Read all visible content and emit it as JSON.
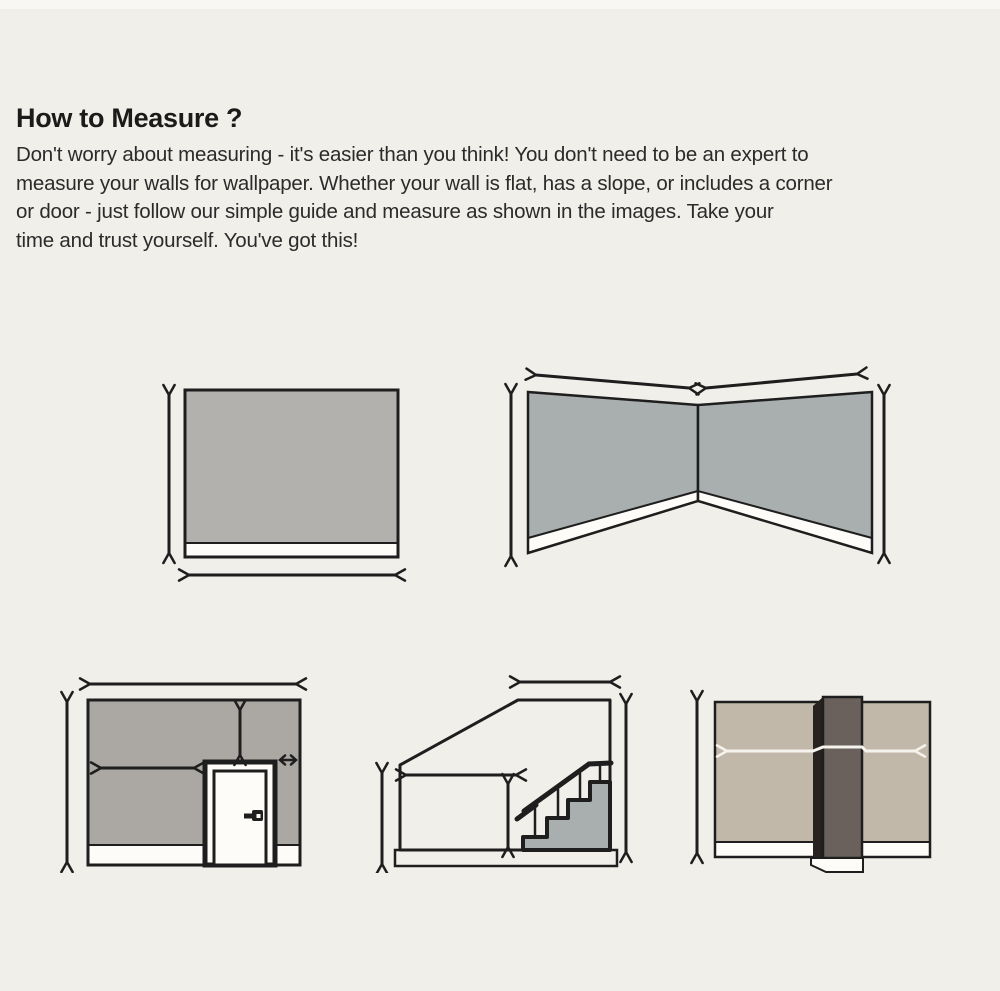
{
  "header": {
    "title": "How to Measure ?",
    "paragraph_lines": [
      "Don't worry about measuring - it's easier than you think! You don't need to be an expert to",
      "measure your walls for wallpaper. Whether your wall is flat, has a slope, or includes a corner",
      "or door - just follow our simple guide and measure as shown in the images. Take your",
      "time and trust yourself. You've got this!"
    ]
  },
  "colors": {
    "background": "#f1efe9",
    "top_strip": "#f9f7f3",
    "ink": "#1e1e1e",
    "wall_flat": "#b3b1ae",
    "wall_cool": "#a9aeae",
    "wall_door": "#aba8a3",
    "wall_taupe": "#c1b8aa",
    "column_front": "#6a605c",
    "column_side": "#27211f",
    "baseboard": "#fdfcf8",
    "arrow_white": "#f6f3ed"
  },
  "diagrams": [
    {
      "name": "flat-wall-diagram"
    },
    {
      "name": "corner-wall-diagram"
    },
    {
      "name": "door-wall-diagram"
    },
    {
      "name": "sloped-wall-stairs-diagram"
    },
    {
      "name": "column-wall-diagram"
    }
  ]
}
